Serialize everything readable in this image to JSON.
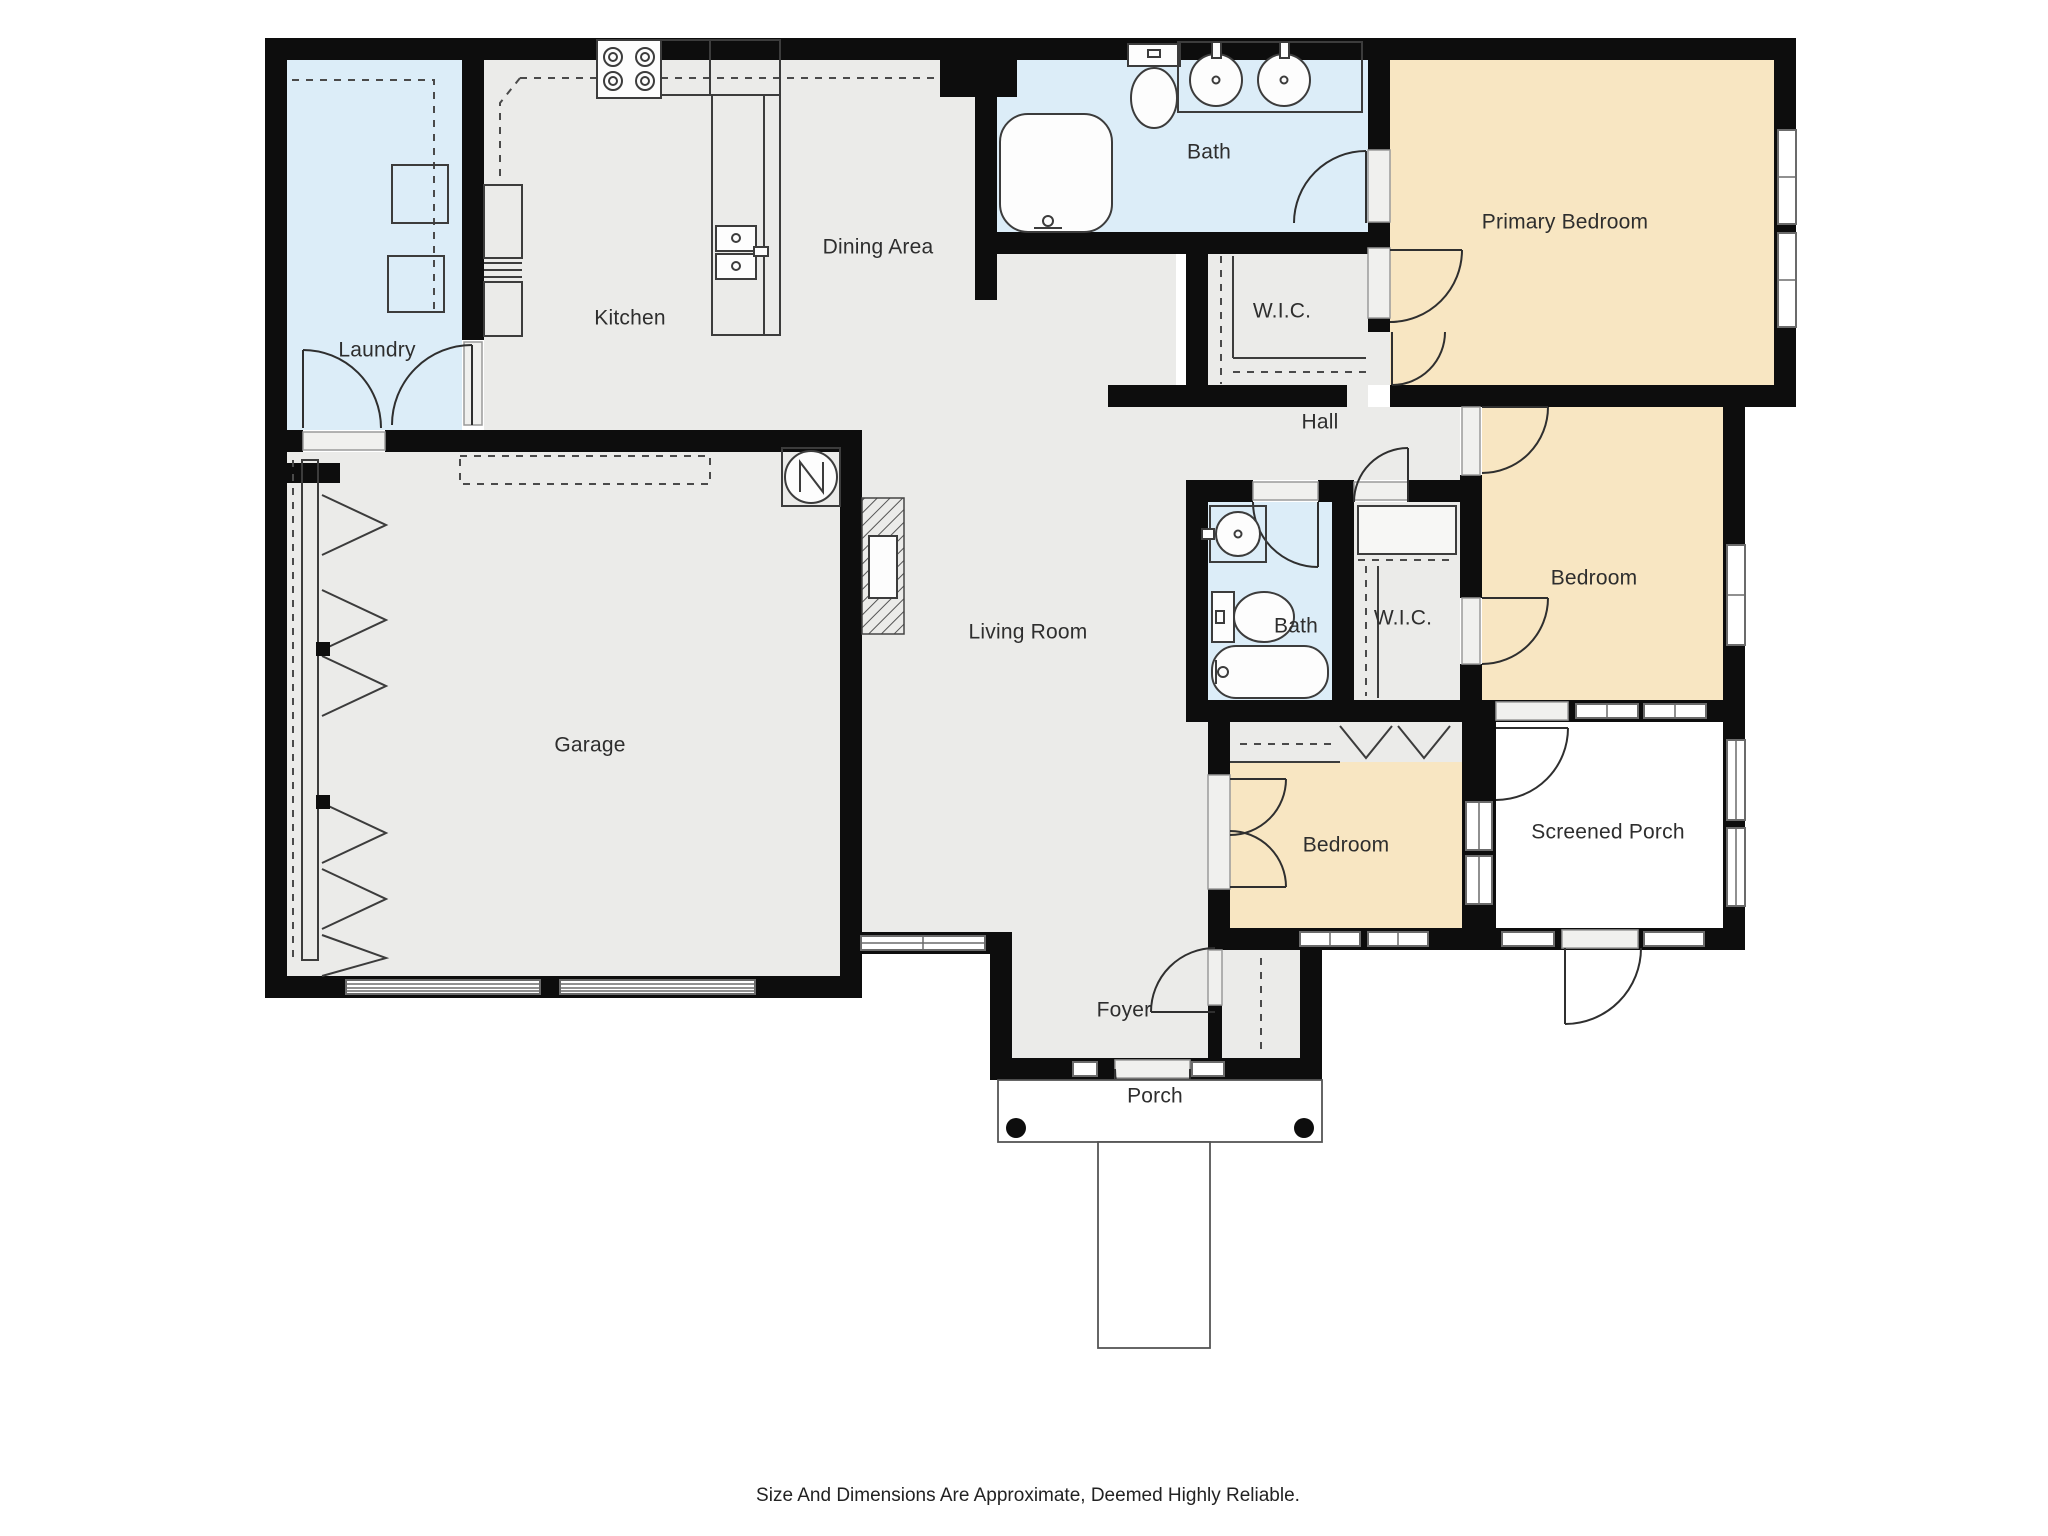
{
  "floor_plan": {
    "labels": {
      "laundry": "Laundry",
      "kitchen": "Kitchen",
      "dining": "Dining Area",
      "bath_top": "Bath",
      "primary_bedroom": "Primary Bedroom",
      "wic_top": "W.I.C.",
      "hall": "Hall",
      "bedroom_right": "Bedroom",
      "bath_mid": "Bath",
      "wic_mid": "W.I.C.",
      "garage": "Garage",
      "living_room": "Living Room",
      "bedroom_bottom": "Bedroom",
      "screened_porch": "Screened Porch",
      "foyer": "Foyer",
      "porch": "Porch"
    },
    "footer": "Size And Dimensions Are Approximate, Deemed Highly Reliable.",
    "colors": {
      "wall": "#0d0d0d",
      "floor_gray": "#ebebe9",
      "floor_blue": "#dcedf8",
      "floor_tan": "#f8e6c2",
      "line": "#3c3c3c",
      "text": "#2e2e2e"
    },
    "icons": [
      "stove-icon",
      "kitchen-sink-icon",
      "fridge-cabinet-icon",
      "washer-icon",
      "dryer-icon",
      "bathtub-icon",
      "toilet-icon",
      "vanity-sink-icon",
      "water-heater-icon",
      "fireplace-icon",
      "garage-door-icon",
      "window-icon",
      "door-arc-icon",
      "closet-rod-icon",
      "bifold-door-icon",
      "porch-post-icon",
      "walkway-icon"
    ]
  }
}
